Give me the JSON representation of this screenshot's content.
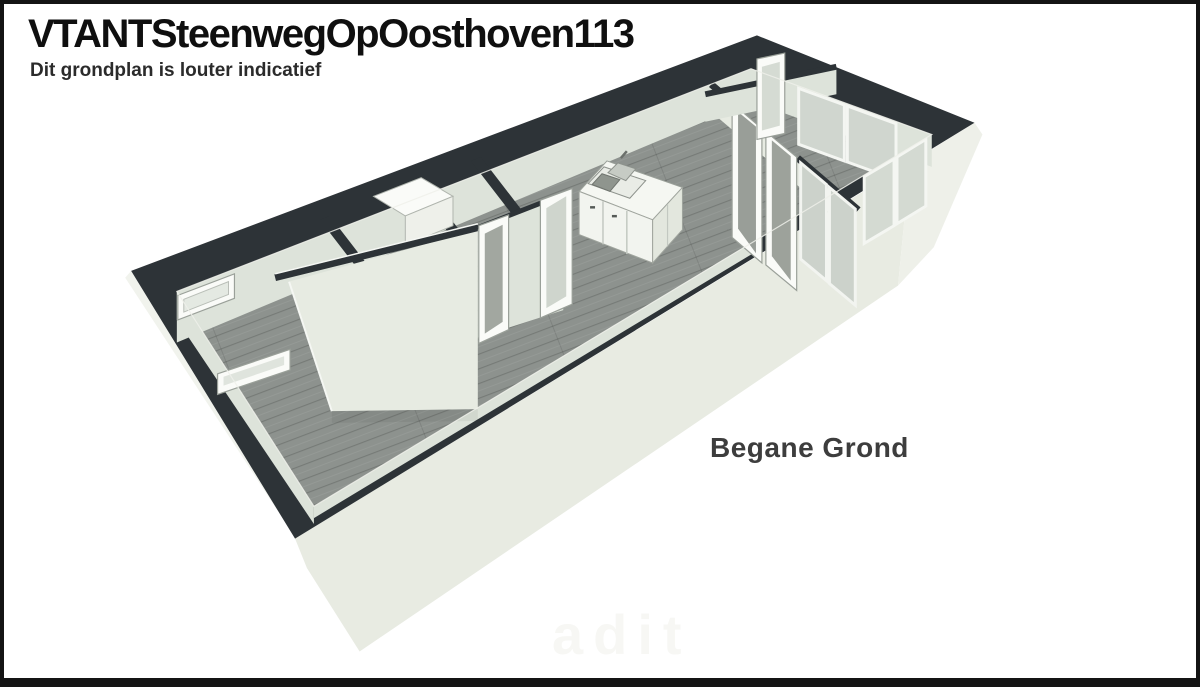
{
  "page": {
    "background": "#ffffff",
    "border_color": "#141414"
  },
  "header": {
    "title": "VTANTSteenwegOpOosthoven113",
    "subtitle": "Dit grondplan is louter indicatief"
  },
  "plan": {
    "floor_label": "Begane Grond",
    "watermark": "adit",
    "view": "3d-isometric-floorplan",
    "colors": {
      "wall_top": "#2d3337",
      "wall_face": "#dde3da",
      "wall_face_bright": "#e7ebe2",
      "exterior_facade": "#e8ebe2",
      "exterior_right": "#eef0e9",
      "exterior_left_sliver": "#f1f3ed",
      "floor": "#8d928e",
      "frame_white": "#fafbf8",
      "glass": "#ccd2cb",
      "kitchen_white": "#f5f7f2"
    }
  }
}
